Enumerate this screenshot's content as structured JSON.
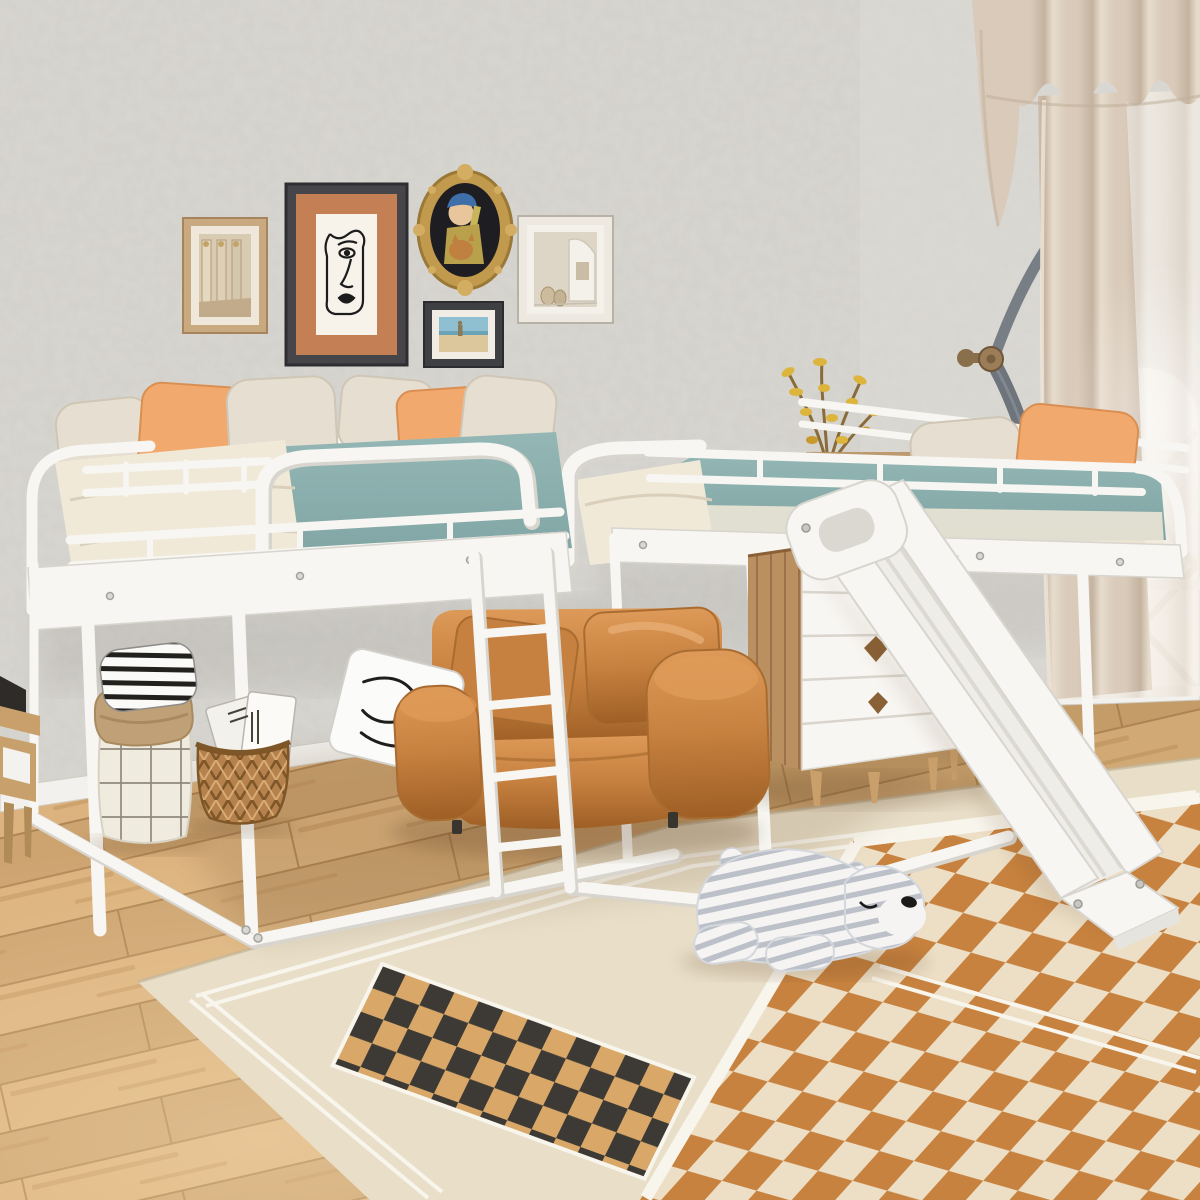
{
  "meta": {
    "type": "product-photograph",
    "description": "Kids bedroom with a white metal L-shaped double twin loft bed with guard rails, a ladder and a white slide. Under the loft: caramel leather armchair with a scribble pillow, white-and-wood dresser with a yellow-flower plant, white grid laundry hamper with a black striped pillow, wicker basket with magazines. Gray plaster wall with five gallery frames, beige curtains over an arched window with a bronze tieback, light oak plank floor, large cream rug with black-and-tan and orange checkerboard panels, and a striped plush polar bear lying on the rug."
  },
  "palette": {
    "wall": "#d2d0ca",
    "wallLight": "#dedcd7",
    "wainscot": "#e9e7e1",
    "baseboard": "#f2f1ed",
    "floorBase": "#cda470",
    "floorLight": "#dcb37e",
    "floorSeam": "#a57b49",
    "rugCream": "#e9dfc9",
    "rugLine": "#f8f5ec",
    "checkBlack": "#3d3a35",
    "checkTan": "#d9a868",
    "checkOrange": "#c8823f",
    "checkCreamLt": "#ecdfc6",
    "bedWhite": "#f7f6f2",
    "bedShadow": "#d8d5cf",
    "mattressTeal": "#94b7b5",
    "mattressTealDark": "#7da3a2",
    "beddingCream": "#f1e9d8",
    "pillowCream": "#e6dfd1",
    "pillowOrange": "#f2a96e",
    "chair": "#c6803f",
    "chairDark": "#9e5f25",
    "chairLight": "#de9a58",
    "pillowWhite": "#fbfbfa",
    "dresserWood": "#bb9061",
    "dresserWhite": "#f8f6f2",
    "legWood": "#c9a06b",
    "curtain": "#d9cab9",
    "curtainDark": "#c5b3a0",
    "curtainLight": "#e7dccd",
    "sheer": "#eee7dd",
    "sash": "#6d747c",
    "knobBronze": "#9b7e58",
    "windowWhite": "#fcfbf8",
    "lattice": "#e8e5df",
    "plantYellow": "#ddb43c",
    "plantStem": "#8a6b3a",
    "hamperCloth": "#f0ebdf",
    "hamperGrid": "#6f675c",
    "hamperRim": "#bfa077",
    "basketBrown": "#b5824d",
    "basketDark": "#7e5627",
    "bearWhite": "#f5f4f2",
    "bearStripe": "#bcc0c9",
    "bearNose": "#1d1b19",
    "frameDark": "#46464a",
    "frameWood": "#c9a980",
    "frameWhiteF": "#eee9e0",
    "matTerracotta": "#c57f55",
    "gold": "#c19a4d",
    "artBlue": "#3f6fa8",
    "artSkin": "#e9c59b",
    "artYellow": "#b9a14c",
    "skyBlue": "#8fc0d2",
    "sandTan": "#dcc79c",
    "inkBlack": "#1c1c1c"
  },
  "scene": {
    "objects": [
      {
        "name": "gallery-frame-columns",
        "desc": "small wood frame, photo of classical columns"
      },
      {
        "name": "gallery-frame-line-art",
        "desc": "large dark frame, terracotta mat, abstract one-line face drawing"
      },
      {
        "name": "gallery-frame-oval-gold",
        "desc": "ornate gold oval frame, girl with pearl earring holding a cat"
      },
      {
        "name": "gallery-frame-beach",
        "desc": "small dark frame, beach photo"
      },
      {
        "name": "gallery-frame-interior",
        "desc": "cream frame, arched interior photo with vases"
      },
      {
        "name": "loft-bed-left",
        "desc": "white metal twin loft bed, teal mattress, cream bedding, orange and cream pillows"
      },
      {
        "name": "loft-bed-right",
        "desc": "white metal twin loft bed set at right angle, teal mattress, pillows at head end"
      },
      {
        "name": "ladder",
        "desc": "white metal ladder to left loft"
      },
      {
        "name": "slide",
        "desc": "white slide from right loft down to rug"
      },
      {
        "name": "armchair",
        "desc": "caramel leather lounge chair with white scribble pillow"
      },
      {
        "name": "dresser",
        "desc": "five-drawer chest, white fronts, wood sides, diamond cutout pulls"
      },
      {
        "name": "plant",
        "desc": "branches with yellow blooms on dresser"
      },
      {
        "name": "curtains",
        "desc": "beige pinch-pleat valance and panels with sheer over arched window"
      },
      {
        "name": "tieback",
        "desc": "bronze wall knob with dark braided sash"
      },
      {
        "name": "hamper",
        "desc": "white grid-pattern fabric hamper with folded tan rim"
      },
      {
        "name": "striped-pillow",
        "desc": "black and white striped pillow on hamper"
      },
      {
        "name": "wicker-basket",
        "desc": "open-weave rattan basket holding magazines"
      },
      {
        "name": "bear-plush",
        "desc": "gray striped plush polar bear lying on rug"
      },
      {
        "name": "area-rug",
        "desc": "cream rug, white border lines, black/tan check strip, orange check field"
      },
      {
        "name": "wood-floor",
        "desc": "light oak planks"
      },
      {
        "name": "side-table",
        "desc": "small wood desk at left edge with dark tablet"
      }
    ]
  }
}
